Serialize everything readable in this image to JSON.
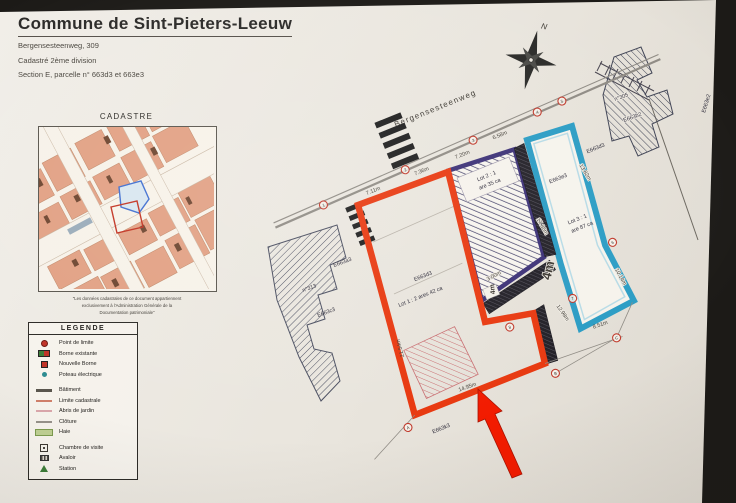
{
  "header": {
    "title": "Commune de Sint-Pieters-Leeuw",
    "address": "Bergensesteenweg, 309",
    "division": "Cadastré 2ème division",
    "section": "Section E, parcelle n° 663d3 et 663e3"
  },
  "cadastre": {
    "title": "CADASTRE",
    "caption1": "\"Les données cadastrales de ce document appartiennent",
    "caption2": "exclusivement à l'Administration Générale de la",
    "caption3": "Documentation patrimoniale\""
  },
  "legend": {
    "title": "LEGENDE",
    "items": [
      {
        "icon": "point-limite",
        "label": "Point de limite"
      },
      {
        "icon": "borne-existante",
        "label": "Borne existante"
      },
      {
        "icon": "nouvelle-borne",
        "label": "Nouvelle Borne"
      },
      {
        "icon": "poteau-electrique",
        "label": "Poteau électrique"
      },
      {
        "icon": "batiment",
        "label": "Bâtiment"
      },
      {
        "icon": "limite-cadastrale",
        "label": "Limite cadastrale"
      },
      {
        "icon": "abris-jardin",
        "label": "Abris de jardin"
      },
      {
        "icon": "cloture",
        "label": "Clôture"
      },
      {
        "icon": "haie",
        "label": "Haie"
      },
      {
        "icon": "chambre-visite",
        "label": "Chambre de visite"
      },
      {
        "icon": "avaloir",
        "label": "Avaloir"
      },
      {
        "icon": "station",
        "label": "Station"
      }
    ]
  },
  "compass": {
    "north": "N"
  },
  "plan": {
    "street": "Bergensesteenweg",
    "labels": {
      "lot1_parcel": "E663d3",
      "lot1_area": "Lot 1 : 2 ares 42 ca",
      "lot2_line1": "Lot 2 : 1",
      "lot2_line2": "are 35 ca",
      "lot3_parcel": "E663e3",
      "lot3_line1": "Lot 3 : 1",
      "lot3_line2": "are 87 ca",
      "left_parcel": "E663a3",
      "left_house": "n°313",
      "left_house_parcel": "E663c3",
      "bottom_parcel": "E663k3",
      "right_parcel": "E663d3",
      "tr_house": "n°305",
      "tr_parcel": "E663b2",
      "far_right_parcel": "E663e2"
    },
    "dims": {
      "red_top": "7.11m",
      "lot2_top": "7.20m",
      "road_left": "7.36m",
      "road_right": "6.58m",
      "red_left": "21.54m",
      "red_bottom": "14.95m",
      "teal_left": "17.86m",
      "teal_right_upper": "13.82m",
      "teal_right_lower": "10.14m",
      "teal_bottom": "8.51m",
      "strip": "12.98m",
      "passage_w1": "4m",
      "passage_w2": "4m",
      "passage_len": "3.00m"
    },
    "markers": [
      "1",
      "2",
      "3",
      "4",
      "5",
      "6",
      "7",
      "8",
      "A",
      "B",
      "C"
    ]
  },
  "colors": {
    "lot1_outline": "#e8380f",
    "lot2_outline": "#3b3076",
    "lot3_outline": "#2a9cc4",
    "annotation_arrow": "#f21b00",
    "paper": "#ece8e0",
    "photo_background": "#1c1a17"
  }
}
